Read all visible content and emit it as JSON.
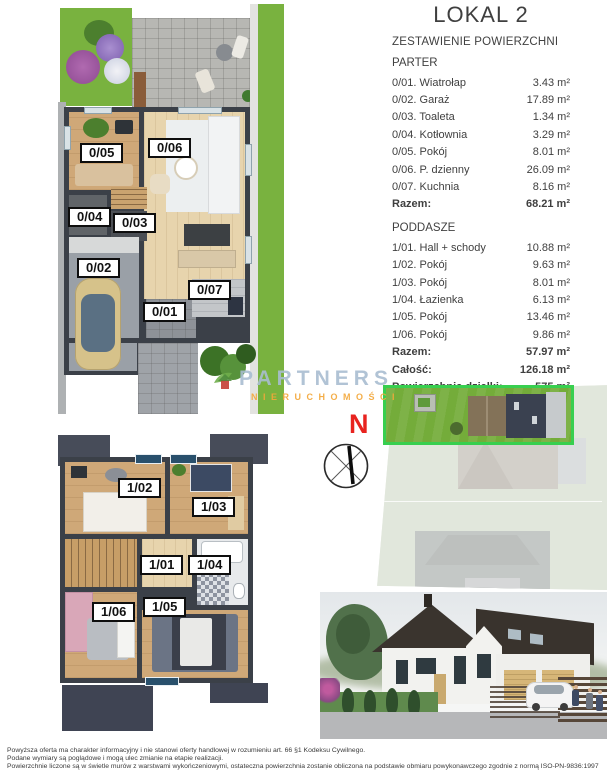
{
  "header": {
    "title": "LOKAL 2",
    "subtitle": "ZESTAWIENIE POWIERZCHNI"
  },
  "areas": {
    "parter": {
      "section_label": "PARTER",
      "rows": [
        {
          "name": "0/01. Wiatrołap",
          "value": "3.43 m²"
        },
        {
          "name": "0/02. Garaż",
          "value": "17.89 m²"
        },
        {
          "name": "0/03. Toaleta",
          "value": "1.34 m²"
        },
        {
          "name": "0/04. Kotłownia",
          "value": "3.29 m²"
        },
        {
          "name": "0/05. Pokój",
          "value": "8.01 m²"
        },
        {
          "name": "0/06. P. dzienny",
          "value": "26.09 m²"
        },
        {
          "name": "0/07. Kuchnia",
          "value": "8.16 m²"
        }
      ],
      "total_label": "Razem:",
      "total_value": "68.21 m²"
    },
    "poddasze": {
      "section_label": "PODDASZE",
      "rows": [
        {
          "name": "1/01. Hall + schody",
          "value": "10.88 m²"
        },
        {
          "name": "1/02. Pokój",
          "value": "9.63 m²"
        },
        {
          "name": "1/03. Pokój",
          "value": "8.01 m²"
        },
        {
          "name": "1/04. Łazienka",
          "value": "6.13 m²"
        },
        {
          "name": "1/05. Pokój",
          "value": "13.46 m²"
        },
        {
          "name": "1/06. Pokój",
          "value": "9.86 m²"
        }
      ],
      "total_label": "Razem:",
      "total_value": "57.97 m²"
    },
    "totals": [
      {
        "name": "Całość:",
        "value": "126.18 m²"
      },
      {
        "name": "Powierzchnia działki:",
        "value": "575 m²"
      }
    ]
  },
  "plans": {
    "ground_rooms": [
      "0/05",
      "0/06",
      "0/04",
      "0/03",
      "0/02",
      "0/07",
      "0/01"
    ],
    "attic_rooms": [
      "1/02",
      "1/03",
      "1/01",
      "1/04",
      "1/06",
      "1/05"
    ]
  },
  "compass": {
    "north_label": "N"
  },
  "watermark": {
    "brand": "PARTNERS",
    "subtitle": "NIERUCHOMOŚCI"
  },
  "disclaimer": {
    "line1": "Powyższa oferta ma charakter informacyjny i nie stanowi oferty handlowej w rozumieniu art. 66 §1 Kodeksu Cywilnego.",
    "line2": "Podane wymiary są poglądowe i mogą ulec zmianie na etapie realizacji.",
    "line3": "Powierzchnie liczone są w świetle murów z warstwami wykończeniowymi, ostateczna powierzchnia zostanie obliczona na podstawie obmiaru powykonawczego zgodnie z normą ISO-PN-9836:1997"
  },
  "colors": {
    "plot_outline_green": "#38cf4f",
    "north_red": "#e8231f",
    "watermark_blue": "#a8bcd0",
    "watermark_orange": "#f3a73a",
    "wall_dark": "#3b4048",
    "grass_green": "#79b23f"
  }
}
